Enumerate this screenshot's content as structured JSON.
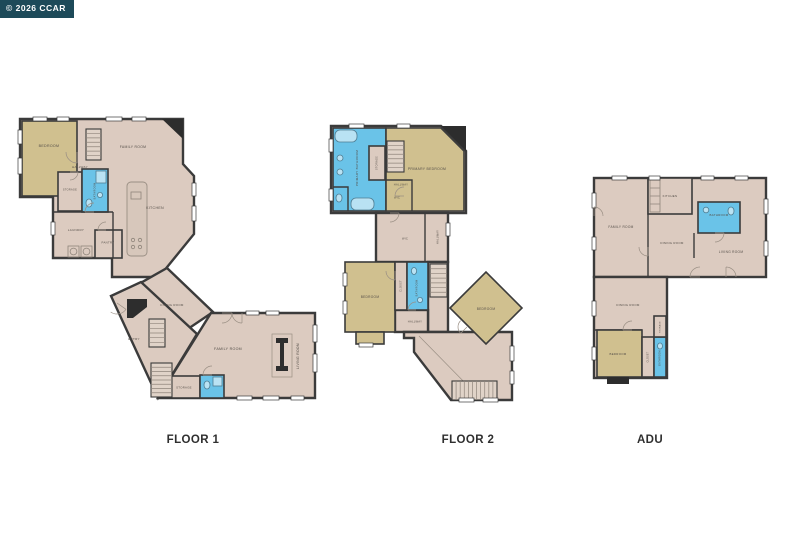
{
  "watermark": {
    "label": "© 2026 CCAR"
  },
  "captions": {
    "floor1": "FLOOR 1",
    "floor2": "FLOOR 2",
    "adu": "ADU"
  },
  "colors": {
    "floor_fill": "#dccbc0",
    "bedroom_fill": "#d0c08f",
    "bathroom_fill": "#6ac3e8",
    "wall": "#3b3b3b",
    "watermark_bg": "#1d4a59",
    "watermark_fg": "#ffffff"
  },
  "floor1": {
    "rooms": {
      "bedroom": "BEDROOM",
      "hallway": "HALLWAY",
      "family_room_top": "FAMILY ROOM",
      "storage_upper": "STORAGE",
      "bathroom_upper": "BATHROOM",
      "kitchen": "KITCHEN",
      "laundry": "LAUNDRY",
      "pantry": "PANTRY",
      "dining_room": "DINING ROOM",
      "entry": "ENTRY",
      "family_room": "FAMILY ROOM",
      "living_room": "LIVING ROOM",
      "storage_lower": "STORAGE"
    }
  },
  "floor2": {
    "rooms": {
      "primary_bathroom": "PRIMARY BATHROOM",
      "storage": "STORAGE",
      "hallway_upper": "HALLWAY",
      "primary_bedroom": "PRIMARY BEDROOM",
      "wic_upper": "WIC",
      "wic_lower": "WIC",
      "hallway_vertical": "HALLWAY",
      "bedroom_left": "BEDROOM",
      "closet": "CLOSET",
      "bathroom": "BATHROOM",
      "hallway_lower": "HALLWAY",
      "bedroom_right": "BEDROOM"
    }
  },
  "adu": {
    "rooms": {
      "kitchen": "KITCHEN",
      "family_room": "FAMILY ROOM",
      "bathroom_main": "BATHROOM",
      "dining_room_upper": "DINING ROOM",
      "living_room": "LIVING ROOM",
      "dining_room_lower": "DINING ROOM",
      "bedroom": "BEDROOM",
      "closet": "CLOSET",
      "bathroom_lower": "BATHROOM",
      "storage": "STORAGE"
    }
  }
}
